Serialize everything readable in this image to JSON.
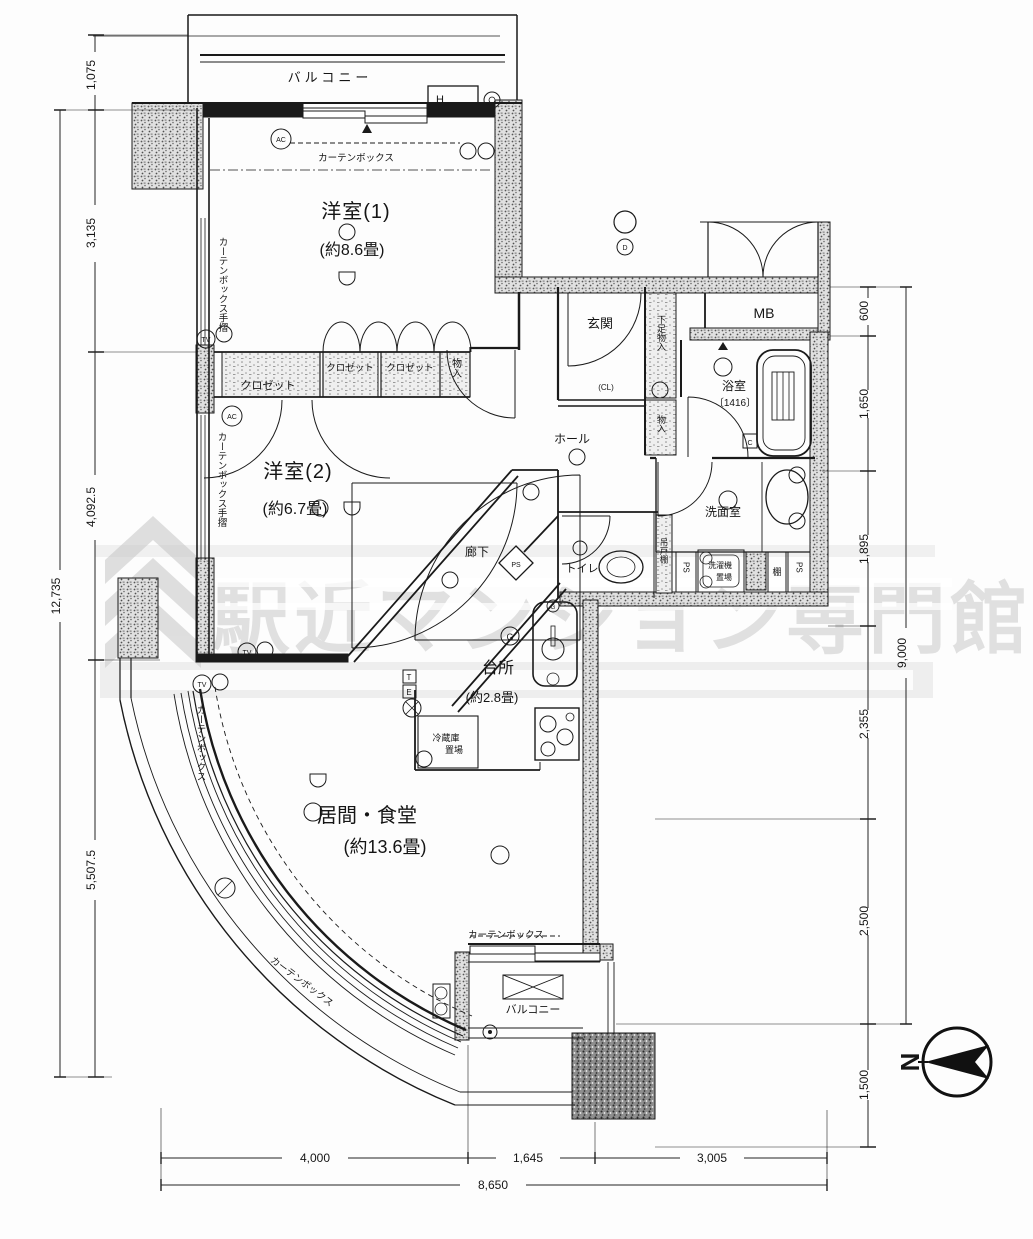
{
  "labels": {
    "balcony": "バルコニー",
    "curtain_box": "カーテンボックス",
    "curtain_box_rail": "カーテンボックス手摺",
    "room1": "洋室(1)",
    "room1_size": "(約8.6畳)",
    "room2": "洋室(2)",
    "room2_size": "(約6.7畳)",
    "living": "居間・食堂",
    "living_size": "(約13.6畳)",
    "kitchen": "台所",
    "kitchen_size": "(約2.8畳)",
    "entrance": "玄関",
    "hall": "ホール",
    "corridor": "廊下",
    "mb": "MB",
    "bath": "浴室",
    "bath_size": "〔1416〕",
    "washroom": "洗面室",
    "toilet": "トイレ",
    "closet": "クロゼット",
    "storage": "物入",
    "shoe_storage": "下足物入",
    "hanging_shelf": "吊戸棚",
    "shelf": "棚",
    "laundry1": "洗濯機",
    "laundry2": "置場",
    "fridge1": "冷蔵庫",
    "fridge2": "置場",
    "ps": "PS",
    "cl": "(CL)"
  },
  "markers": {
    "tv": "TV",
    "ac": "AC",
    "g": "G",
    "d": "D",
    "h": "H",
    "c": "C",
    "t": "T",
    "e": "E",
    "north": "N"
  },
  "dims": {
    "left": [
      "1,075",
      "3,135",
      "4,092.5",
      "5,507.5"
    ],
    "left_total": "12,735",
    "right": [
      "600",
      "1,650",
      "1,895",
      "2,355",
      "2,500",
      "1,500"
    ],
    "right_total": "9,000",
    "bottom": [
      "4,000",
      "1,645",
      "3,005"
    ],
    "bottom_total": "8,650"
  },
  "watermark": {
    "text": "駅近マンション専門館"
  }
}
